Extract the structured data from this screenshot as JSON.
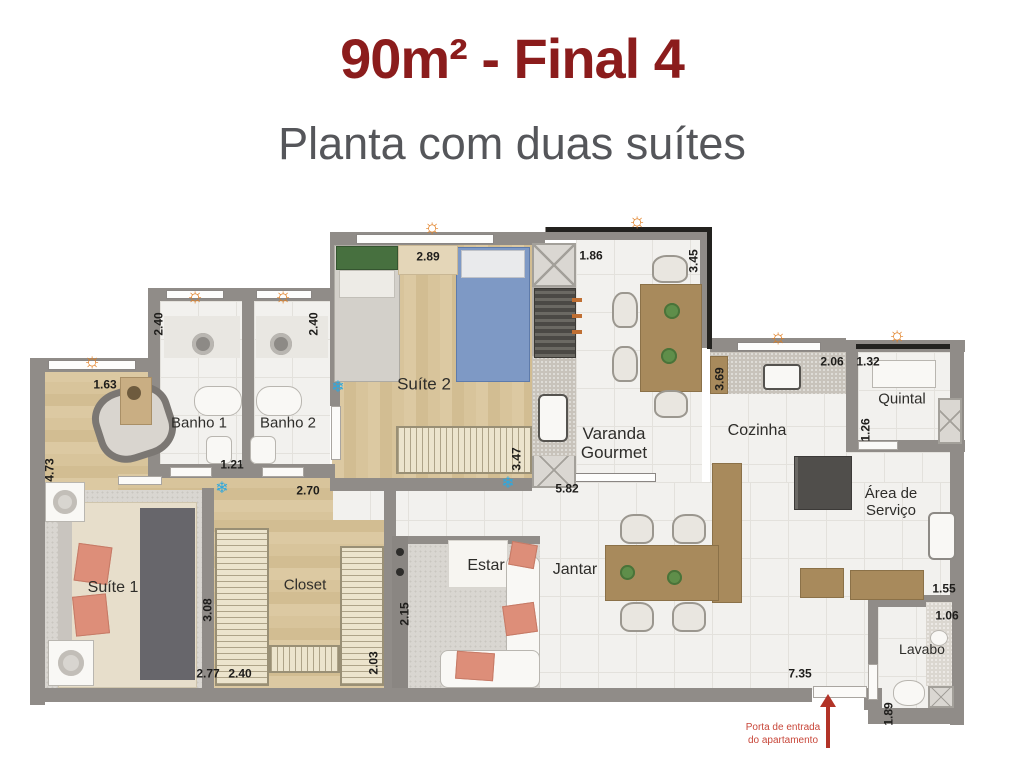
{
  "header": {
    "title": "90m² - Final 4",
    "subtitle": "Planta com duas suítes"
  },
  "icons": {
    "sun": "☼",
    "snowflake": "❄",
    "sun_color": "#e07c1e",
    "snow_color": "#2fa8de"
  },
  "colors": {
    "title": "#8b1c1c",
    "subtitle": "#55565a",
    "wall": "#908c88",
    "arrow_red": "#b23327"
  },
  "plan": {
    "room_labels": [
      {
        "name": "banho-1",
        "text": "Banho 1",
        "x": 199,
        "y": 424,
        "fs": 15
      },
      {
        "name": "banho-2",
        "text": "Banho 2",
        "x": 288,
        "y": 424,
        "fs": 15
      },
      {
        "name": "suite-2",
        "text": "Suíte 2",
        "x": 424,
        "y": 384,
        "fs": 17
      },
      {
        "name": "varanda-gourmet",
        "text": "Varanda\nGourmet",
        "x": 614,
        "y": 443,
        "fs": 17
      },
      {
        "name": "cozinha",
        "text": "Cozinha",
        "x": 757,
        "y": 431,
        "fs": 16
      },
      {
        "name": "quintal",
        "text": "Quintal",
        "x": 902,
        "y": 400,
        "fs": 15
      },
      {
        "name": "area-de-servico",
        "text": "Área de\nServiço",
        "x": 891,
        "y": 503,
        "fs": 15
      },
      {
        "name": "suite-1",
        "text": "Suíte 1",
        "x": 113,
        "y": 588,
        "fs": 16
      },
      {
        "name": "closet",
        "text": "Closet",
        "x": 305,
        "y": 586,
        "fs": 15
      },
      {
        "name": "estar",
        "text": "Estar",
        "x": 486,
        "y": 566,
        "fs": 16
      },
      {
        "name": "jantar",
        "text": "Jantar",
        "x": 575,
        "y": 570,
        "fs": 16
      },
      {
        "name": "lavabo",
        "text": "Lavabo",
        "x": 922,
        "y": 650,
        "fs": 14
      }
    ],
    "measurements": [
      {
        "text": "1.63",
        "x": 105,
        "y": 385,
        "rot": false
      },
      {
        "text": "2.89",
        "x": 428,
        "y": 257,
        "rot": false
      },
      {
        "text": "1.86",
        "x": 591,
        "y": 256,
        "rot": false
      },
      {
        "text": "2.06",
        "x": 832,
        "y": 362,
        "rot": false
      },
      {
        "text": "1.32",
        "x": 868,
        "y": 362,
        "rot": false
      },
      {
        "text": "1.21",
        "x": 232,
        "y": 465,
        "rot": false
      },
      {
        "text": "2.70",
        "x": 308,
        "y": 491,
        "rot": false
      },
      {
        "text": "5.82",
        "x": 567,
        "y": 489,
        "rot": false
      },
      {
        "text": "2.77",
        "x": 208,
        "y": 674,
        "rot": false
      },
      {
        "text": "2.40",
        "x": 240,
        "y": 674,
        "rot": false
      },
      {
        "text": "7.35",
        "x": 800,
        "y": 674,
        "rot": false
      },
      {
        "text": "1.55",
        "x": 944,
        "y": 589,
        "rot": false
      },
      {
        "text": "1.06",
        "x": 947,
        "y": 616,
        "rot": false
      },
      {
        "text": "2.40",
        "x": 159,
        "y": 324,
        "rot": true
      },
      {
        "text": "2.40",
        "x": 314,
        "y": 324,
        "rot": true
      },
      {
        "text": "3.45",
        "x": 694,
        "y": 261,
        "rot": true
      },
      {
        "text": "3.69",
        "x": 720,
        "y": 379,
        "rot": true
      },
      {
        "text": "1.26",
        "x": 866,
        "y": 430,
        "rot": true
      },
      {
        "text": "4.73",
        "x": 50,
        "y": 470,
        "rot": true
      },
      {
        "text": "3.47",
        "x": 517,
        "y": 459,
        "rot": true
      },
      {
        "text": "3.08",
        "x": 208,
        "y": 610,
        "rot": true
      },
      {
        "text": "2.15",
        "x": 405,
        "y": 614,
        "rot": true
      },
      {
        "text": "2.03",
        "x": 374,
        "y": 663,
        "rot": true
      },
      {
        "text": "1.89",
        "x": 889,
        "y": 714,
        "rot": true
      }
    ],
    "sun_markers": [
      {
        "x": 195,
        "y": 296
      },
      {
        "x": 283,
        "y": 296
      },
      {
        "x": 92,
        "y": 361
      },
      {
        "x": 432,
        "y": 227
      },
      {
        "x": 637,
        "y": 221
      },
      {
        "x": 778,
        "y": 337
      },
      {
        "x": 897,
        "y": 335
      }
    ],
    "snow_markers": [
      {
        "x": 338,
        "y": 388
      },
      {
        "x": 222,
        "y": 489
      },
      {
        "x": 508,
        "y": 484
      }
    ],
    "entrance": {
      "line1": "Porta de entrada",
      "line2": "do apartamento"
    }
  }
}
